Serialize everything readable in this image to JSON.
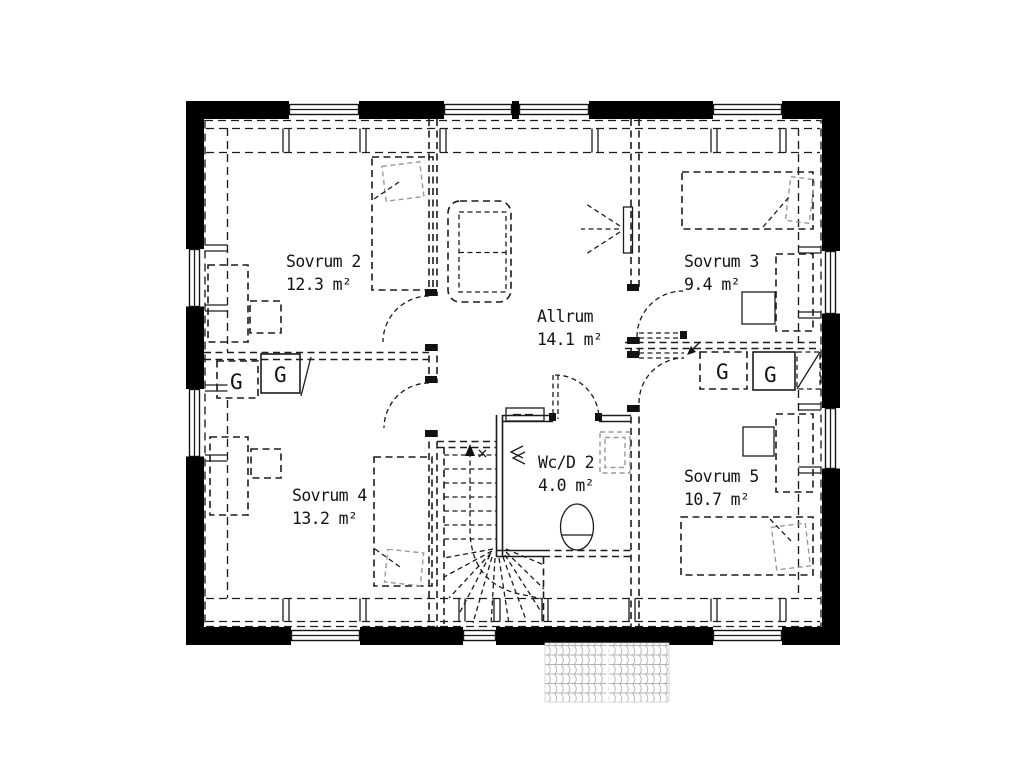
{
  "rooms": [
    {
      "id": "sovrum2",
      "name": "Sovrum 2",
      "area": "12.3 m²"
    },
    {
      "id": "sovrum3",
      "name": "Sovrum 3",
      "area": "9.4 m²"
    },
    {
      "id": "allrum",
      "name": "Allrum",
      "area": "14.1 m²"
    },
    {
      "id": "sovrum4",
      "name": "Sovrum 4",
      "area": "13.2 m²"
    },
    {
      "id": "wcd2",
      "name": "Wc/D 2",
      "area": "4.0 m²"
    },
    {
      "id": "sovrum5",
      "name": "Sovrum 5",
      "area": "10.7 m²"
    }
  ],
  "closet_label": "G",
  "symbols": {
    "toilet": "toilet-icon",
    "washbasin": "washbasin-icon",
    "wardrobe": "wardrobe-box",
    "staircase": "staircase-with-winders",
    "wall_lamp": "wall-light-rays-icon",
    "ventilation": "vent-arrows-icon",
    "roof": "roof-tile-hatch"
  },
  "colors": {
    "walls": "#000000",
    "lines": "#1c1c1c",
    "secondary_gray": "#999999",
    "roof_tile_gray": "#b3b3b3",
    "background": "#ffffff"
  }
}
